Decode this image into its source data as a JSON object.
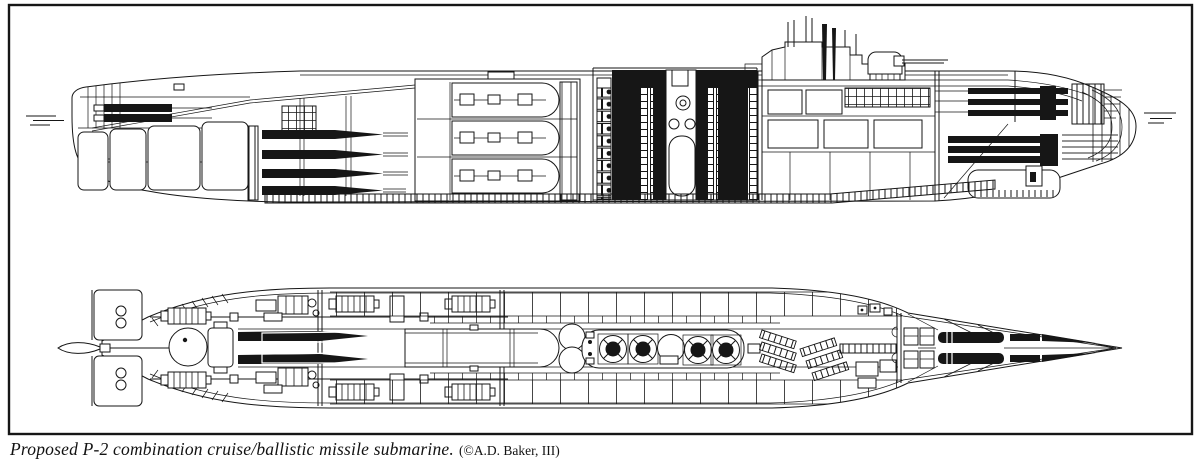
{
  "figure": {
    "caption": "Proposed P-2 combination cruise/ballistic missile submarine.",
    "credit": "(©A.D. Baker, III)"
  },
  "colors": {
    "ink": "#161616",
    "paper": "#ffffff"
  },
  "views": {
    "top": "inboard-profile-cutaway",
    "bottom": "plan-view-cutaway"
  }
}
